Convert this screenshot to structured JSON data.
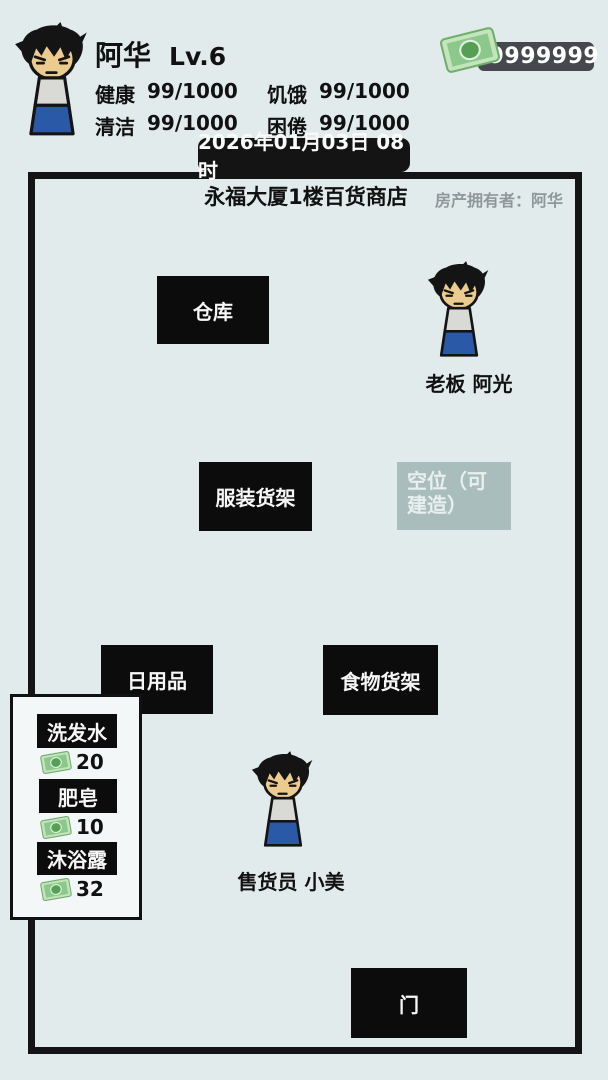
{
  "hud": {
    "player_name": "阿华",
    "level": "Lv.6",
    "money": "99999999",
    "stats": [
      {
        "label": "健康",
        "value": "99/1000"
      },
      {
        "label": "饥饿",
        "value": "99/1000"
      },
      {
        "label": "清洁",
        "value": "99/1000"
      },
      {
        "label": "困倦",
        "value": "99/1000"
      }
    ],
    "datetime": "2026年01月03日 08时"
  },
  "shop": {
    "title": "永福大厦1楼百货商店",
    "owner": "房产拥有者：阿华",
    "fixtures": {
      "warehouse": "仓库",
      "clothing_shelf": "服装货架",
      "empty_slot": "空位（可建造）",
      "daily_goods": "日用品",
      "food_shelf": "食物货架",
      "door": "门"
    },
    "npcs": {
      "boss": "老板 阿光",
      "clerk": "售货员 小美"
    }
  },
  "price_list": {
    "items": [
      {
        "name": "洗发水",
        "price": "20"
      },
      {
        "name": "肥皂",
        "price": "10"
      },
      {
        "name": "沐浴露",
        "price": "32"
      }
    ]
  },
  "colors": {
    "background": "#e2ebeb",
    "box_black": "#0c0c0c",
    "empty_slot_gray": "#a9bdbd",
    "money_badge_gray": "#45494d",
    "bill_green": "#8cc88c",
    "pants_blue": "#2a59a8",
    "shirt_gray": "#d9d9d5",
    "face_tan": "#eccb8e",
    "owner_text_gray": "#8e979a"
  }
}
